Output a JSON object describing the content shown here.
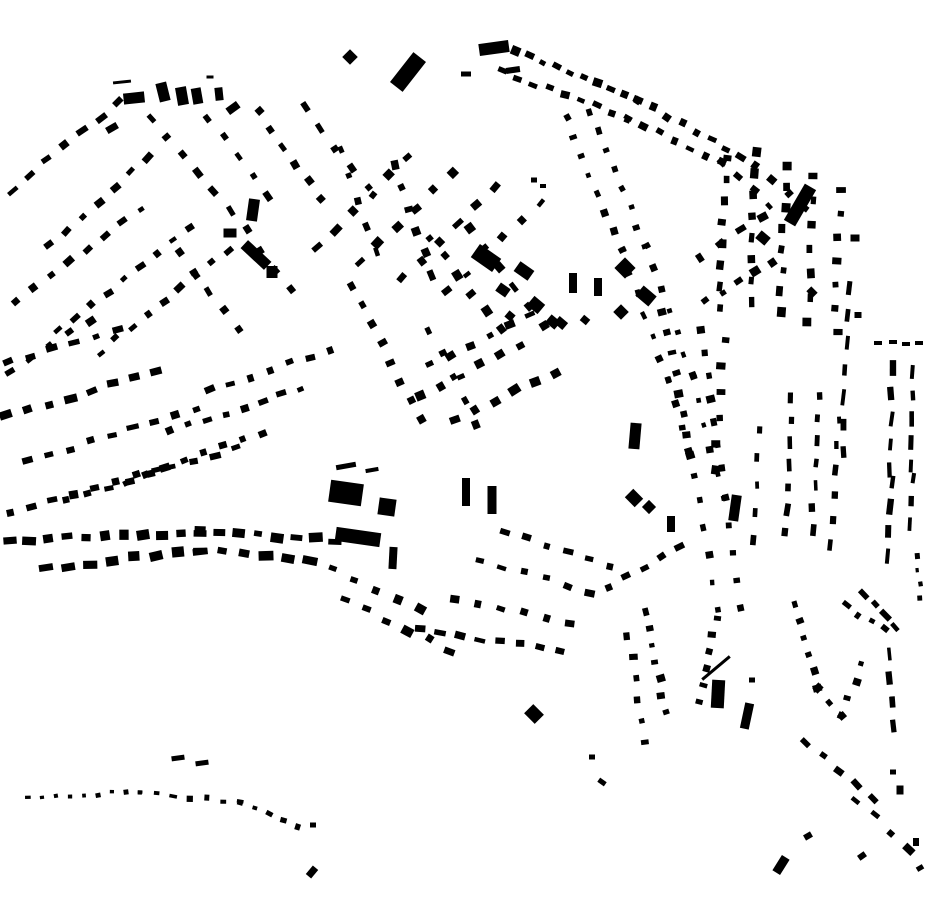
{
  "map": {
    "background": "#ffffff",
    "building_color": "#000000",
    "rows": [
      [
        12,
        190,
        118,
        102,
        7,
        10,
        6
      ],
      [
        50,
        246,
        148,
        158,
        7,
        9,
        6
      ],
      [
        16,
        302,
        140,
        208,
        8,
        8,
        6
      ],
      [
        58,
        330,
        190,
        228,
        9,
        8,
        6
      ],
      [
        100,
        352,
        228,
        250,
        9,
        8,
        6
      ],
      [
        10,
        372,
        90,
        320,
        5,
        8,
        6
      ],
      [
        152,
        118,
        212,
        192,
        5,
        8,
        6
      ],
      [
        208,
        118,
        268,
        196,
        5,
        8,
        6
      ],
      [
        258,
        112,
        322,
        198,
        6,
        8,
        6
      ],
      [
        304,
        108,
        368,
        188,
        5,
        8,
        6
      ],
      [
        232,
        210,
        290,
        290,
        5,
        8,
        6
      ],
      [
        180,
        252,
        238,
        330,
        5,
        8,
        6
      ],
      [
        318,
        248,
        408,
        158,
        6,
        9,
        7
      ],
      [
        360,
        262,
        452,
        172,
        6,
        9,
        7
      ],
      [
        402,
        278,
        496,
        188,
        6,
        9,
        7
      ],
      [
        448,
        292,
        540,
        202,
        6,
        8,
        6
      ],
      [
        430,
        238,
        500,
        330,
        6,
        8,
        7
      ],
      [
        470,
        228,
        545,
        325,
        6,
        8,
        7
      ],
      [
        8,
        362,
        118,
        330,
        6,
        9,
        7
      ],
      [
        6,
        416,
        156,
        372,
        8,
        10,
        7
      ],
      [
        28,
        462,
        196,
        408,
        9,
        10,
        7
      ],
      [
        10,
        512,
        158,
        470,
        8,
        10,
        7
      ],
      [
        66,
        500,
        236,
        448,
        9,
        9,
        6
      ],
      [
        126,
        482,
        262,
        432,
        8,
        8,
        6
      ],
      [
        170,
        432,
        300,
        388,
        8,
        8,
        6
      ],
      [
        210,
        390,
        330,
        350,
        7,
        8,
        6
      ],
      [
        10,
        540,
        200,
        532,
        11,
        11,
        8
      ],
      [
        200,
        532,
        335,
        540,
        8,
        11,
        8
      ],
      [
        46,
        568,
        200,
        550,
        8,
        12,
        8
      ],
      [
        200,
        550,
        310,
        560,
        6,
        12,
        8
      ],
      [
        310,
        560,
        420,
        610,
        6,
        10,
        7
      ],
      [
        345,
        600,
        450,
        650,
        6,
        9,
        7
      ],
      [
        420,
        630,
        560,
        650,
        8,
        9,
        6
      ],
      [
        455,
        598,
        570,
        622,
        6,
        8,
        6
      ],
      [
        480,
        560,
        590,
        592,
        6,
        8,
        6
      ],
      [
        505,
        532,
        610,
        566,
        6,
        8,
        6
      ],
      [
        28,
        799,
        140,
        791,
        9,
        5,
        4
      ],
      [
        140,
        791,
        240,
        803,
        7,
        6,
        5
      ],
      [
        240,
        803,
        298,
        826,
        5,
        6,
        5
      ],
      [
        352,
        286,
        420,
        420,
        8,
        8,
        7
      ],
      [
        395,
        165,
        432,
        275,
        6,
        8,
        7
      ],
      [
        340,
        150,
        376,
        252,
        5,
        7,
        6
      ],
      [
        430,
        330,
        475,
        425,
        5,
        7,
        6
      ],
      [
        420,
        395,
        520,
        345,
        6,
        9,
        7
      ],
      [
        455,
        420,
        555,
        372,
        6,
        9,
        7
      ],
      [
        430,
        365,
        530,
        315,
        6,
        8,
        6
      ],
      [
        566,
        118,
        622,
        250,
        8,
        6,
        6
      ],
      [
        590,
        112,
        646,
        246,
        8,
        6,
        6
      ],
      [
        622,
        250,
        668,
        380,
        7,
        6,
        6
      ],
      [
        646,
        246,
        692,
        376,
        7,
        6,
        6
      ],
      [
        668,
        380,
        700,
        500,
        6,
        6,
        6
      ],
      [
        692,
        376,
        724,
        498,
        6,
        6,
        6
      ],
      [
        700,
        500,
        716,
        610,
        5,
        6,
        6
      ],
      [
        724,
        498,
        740,
        608,
        5,
        6,
        6
      ],
      [
        662,
        312,
        692,
        455,
        8,
        6,
        7
      ],
      [
        700,
        330,
        722,
        468,
        7,
        6,
        7
      ],
      [
        516,
        50,
        638,
        100,
        10,
        8,
        7
      ],
      [
        638,
        100,
        756,
        164,
        9,
        8,
        7
      ],
      [
        502,
        72,
        628,
        118,
        9,
        8,
        6
      ],
      [
        628,
        118,
        722,
        162,
        7,
        7,
        6
      ],
      [
        756,
        164,
        806,
        208,
        4,
        7,
        7
      ],
      [
        722,
        162,
        770,
        205,
        4,
        7,
        6
      ],
      [
        726,
        158,
        720,
        308,
        8,
        8,
        7
      ],
      [
        756,
        152,
        750,
        302,
        8,
        8,
        7
      ],
      [
        786,
        166,
        780,
        312,
        8,
        8,
        7
      ],
      [
        814,
        176,
        808,
        322,
        7,
        8,
        7
      ],
      [
        840,
        190,
        836,
        332,
        7,
        7,
        8
      ],
      [
        848,
        288,
        842,
        452,
        7,
        15,
        5
      ],
      [
        700,
        258,
        762,
        216,
        4,
        8,
        7
      ],
      [
        706,
        302,
        772,
        262,
        5,
        8,
        7
      ],
      [
        724,
        340,
        716,
        470,
        6,
        7,
        8
      ],
      [
        792,
        398,
        784,
        532,
        7,
        10,
        5
      ],
      [
        820,
        396,
        812,
        530,
        7,
        10,
        5
      ],
      [
        760,
        430,
        752,
        540,
        5,
        9,
        5
      ],
      [
        838,
        420,
        830,
        545,
        6,
        9,
        5
      ],
      [
        608,
        586,
        680,
        548,
        5,
        8,
        6
      ],
      [
        893,
        368,
        890,
        470,
        5,
        13,
        5
      ],
      [
        891,
        482,
        886,
        556,
        4,
        13,
        5
      ],
      [
        913,
        372,
        911,
        466,
        5,
        12,
        5
      ],
      [
        912,
        478,
        908,
        524,
        3,
        11,
        5
      ],
      [
        918,
        556,
        921,
        598,
        4,
        6,
        4
      ],
      [
        864,
        594,
        896,
        626,
        4,
        10,
        6
      ],
      [
        645,
        612,
        666,
        712,
        7,
        6,
        7
      ],
      [
        700,
        702,
        716,
        618,
        6,
        6,
        7
      ],
      [
        628,
        636,
        646,
        742,
        6,
        6,
        7
      ],
      [
        796,
        604,
        818,
        688,
        6,
        6,
        7
      ],
      [
        818,
        688,
        842,
        716,
        3,
        6,
        7
      ],
      [
        842,
        716,
        862,
        664,
        4,
        6,
        7
      ],
      [
        846,
        606,
        884,
        630,
        4,
        7,
        6
      ],
      [
        890,
        654,
        893,
        726,
        4,
        11,
        5
      ],
      [
        806,
        742,
        872,
        800,
        5,
        9,
        6
      ],
      [
        856,
        800,
        910,
        848,
        4,
        9,
        6
      ]
    ],
    "buildings": [
      [
        122,
        82,
        18,
        3,
        -6
      ],
      [
        134,
        98,
        21,
        11,
        -6
      ],
      [
        163,
        92,
        11,
        19,
        -14
      ],
      [
        182,
        96,
        11,
        18,
        -10
      ],
      [
        197,
        96,
        10,
        16,
        -10
      ],
      [
        210,
        77,
        7,
        3,
        0
      ],
      [
        219,
        94,
        8,
        13,
        -6
      ],
      [
        233,
        108,
        13,
        8,
        -36
      ],
      [
        112,
        128,
        12,
        7,
        -30
      ],
      [
        350,
        57,
        11,
        11,
        45
      ],
      [
        408,
        72,
        16,
        38,
        38
      ],
      [
        466,
        74,
        10,
        5,
        0
      ],
      [
        494,
        48,
        30,
        12,
        -8
      ],
      [
        513,
        70,
        14,
        6,
        -8
      ],
      [
        534,
        180,
        6,
        5,
        0
      ],
      [
        543,
        186,
        6,
        4,
        0
      ],
      [
        486,
        258,
        26,
        16,
        35
      ],
      [
        524,
        271,
        17,
        12,
        35
      ],
      [
        503,
        290,
        12,
        10,
        35
      ],
      [
        536,
        305,
        14,
        12,
        40
      ],
      [
        553,
        322,
        12,
        10,
        40
      ],
      [
        510,
        316,
        8,
        8,
        40
      ],
      [
        625,
        268,
        15,
        15,
        45
      ],
      [
        646,
        296,
        17,
        13,
        40
      ],
      [
        621,
        312,
        11,
        11,
        45
      ],
      [
        573,
        283,
        8,
        20,
        0
      ],
      [
        598,
        287,
        8,
        18,
        0
      ],
      [
        561,
        323,
        11,
        9,
        40
      ],
      [
        585,
        320,
        8,
        7,
        40
      ],
      [
        253,
        210,
        11,
        22,
        8
      ],
      [
        230,
        233,
        13,
        9,
        0
      ],
      [
        256,
        255,
        32,
        11,
        43
      ],
      [
        272,
        272,
        11,
        12,
        0
      ],
      [
        346,
        466,
        20,
        5,
        -10
      ],
      [
        372,
        470,
        13,
        4,
        -10
      ],
      [
        346,
        493,
        33,
        22,
        8
      ],
      [
        387,
        507,
        17,
        17,
        8
      ],
      [
        358,
        537,
        45,
        14,
        8
      ],
      [
        393,
        558,
        8,
        22,
        3
      ],
      [
        466,
        492,
        8,
        28,
        0
      ],
      [
        492,
        500,
        9,
        28,
        0
      ],
      [
        635,
        436,
        11,
        26,
        5
      ],
      [
        634,
        498,
        14,
        12,
        45
      ],
      [
        649,
        507,
        10,
        10,
        45
      ],
      [
        671,
        524,
        8,
        16,
        0
      ],
      [
        735,
        508,
        10,
        26,
        8
      ],
      [
        718,
        694,
        13,
        28,
        3
      ],
      [
        716,
        668,
        36,
        3,
        -40
      ],
      [
        747,
        716,
        9,
        26,
        12
      ],
      [
        752,
        680,
        6,
        5,
        0
      ],
      [
        534,
        714,
        15,
        13,
        45
      ],
      [
        800,
        205,
        13,
        42,
        30
      ],
      [
        763,
        238,
        12,
        10,
        40
      ],
      [
        855,
        238,
        9,
        7,
        0
      ],
      [
        812,
        292,
        9,
        7,
        45
      ],
      [
        858,
        315,
        7,
        6,
        0
      ],
      [
        878,
        343,
        8,
        4,
        0
      ],
      [
        893,
        342,
        8,
        4,
        0
      ],
      [
        906,
        344,
        8,
        4,
        0
      ],
      [
        919,
        343,
        8,
        4,
        0
      ],
      [
        592,
        757,
        6,
        5,
        0
      ],
      [
        602,
        782,
        8,
        5,
        35
      ],
      [
        313,
        825,
        6,
        5,
        0
      ],
      [
        312,
        872,
        7,
        11,
        40
      ],
      [
        178,
        758,
        13,
        5,
        -8
      ],
      [
        202,
        763,
        13,
        5,
        -8
      ],
      [
        781,
        865,
        9,
        18,
        32
      ],
      [
        808,
        836,
        8,
        6,
        -30
      ],
      [
        862,
        856,
        8,
        6,
        -35
      ],
      [
        900,
        790,
        7,
        9,
        0
      ],
      [
        916,
        842,
        6,
        8,
        0
      ],
      [
        920,
        868,
        7,
        5,
        -30
      ],
      [
        893,
        772,
        6,
        5,
        0
      ]
    ]
  }
}
